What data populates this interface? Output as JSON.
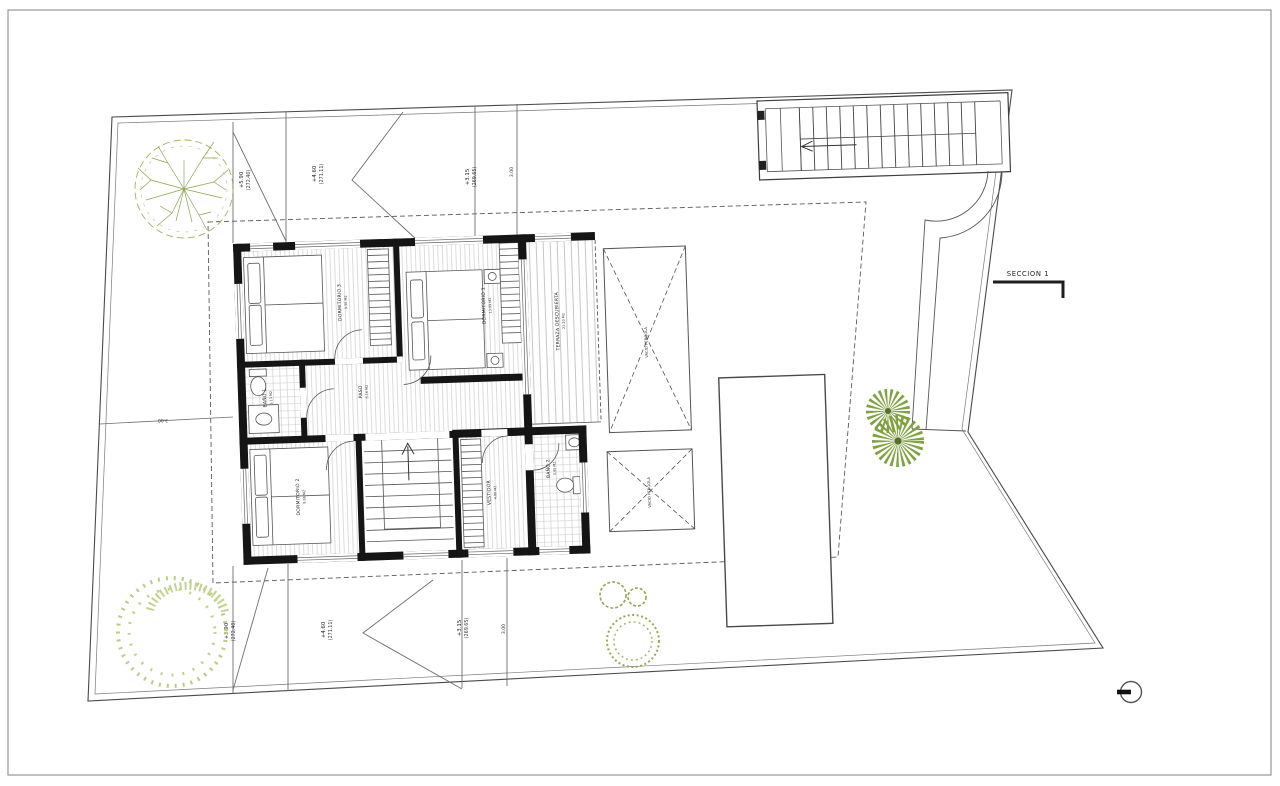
{
  "drawing": {
    "section": {
      "label": "SECCION 1"
    },
    "rooms": {
      "dormitorio1": {
        "name": "DORMITORIO 1",
        "area": "13.09 M2"
      },
      "dormitorio2": {
        "name": "DORMITORIO 2",
        "area": "8.66 M2"
      },
      "dormitorio3": {
        "name": "DORMITORIO 3",
        "area": "9.50 M2"
      },
      "bano1": {
        "name": "BAÑO 1",
        "area": "3.13 M2"
      },
      "bano2": {
        "name": "BAÑO 2",
        "area": "3.45 M2"
      },
      "paso": {
        "name": "PASO",
        "area": "8.16 M2"
      },
      "vestidor": {
        "name": "VESTIDOR",
        "area": "4.00 M2"
      },
      "terraza": {
        "name": "TERRAZA DESCUBIERTA",
        "area": "21.20 M2"
      },
      "vacio_pergola": {
        "name": "VACIO PERGOLA"
      }
    },
    "roof_levels": {
      "top": [
        {
          "level": "+5.90",
          "elevation": "(272.40)"
        },
        {
          "level": "+4.60",
          "elevation": "(271.11)"
        },
        {
          "level": "+3.15",
          "elevation": "(269.65)"
        },
        {
          "level": "3.00",
          "elevation": ""
        }
      ],
      "bottom": [
        {
          "level": "+5.90",
          "elevation": "(272.40)"
        },
        {
          "level": "+4.60",
          "elevation": "(271.11)"
        },
        {
          "level": "+3.15",
          "elevation": "(269.65)"
        },
        {
          "level": "3.00",
          "elevation": ""
        }
      ]
    },
    "dimensions": {
      "left_offset": "3.00"
    },
    "colors": {
      "line": "#4a4a4a",
      "wall": "#151515",
      "hatch": "#c9c9c9",
      "tree_green": "#8ca64b",
      "bush_green": "#b9cc80",
      "dandelion_green": "#7fa23e"
    }
  }
}
